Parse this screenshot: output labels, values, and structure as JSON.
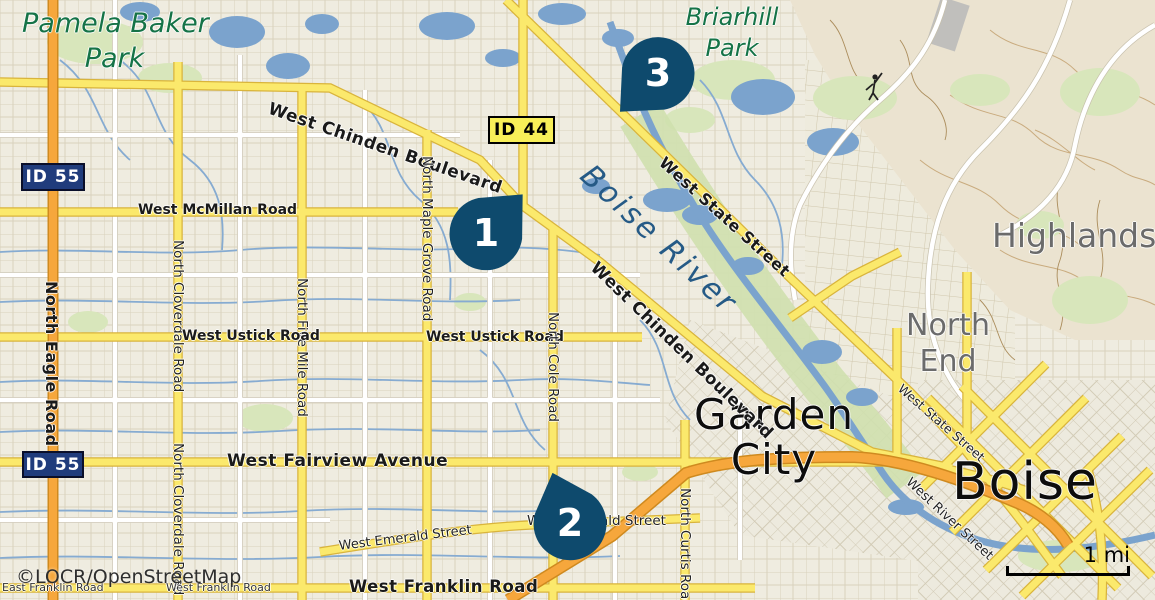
{
  "attribution": "©LOCR/OpenStreetMap",
  "scale_bar": {
    "label": "1 mi"
  },
  "markers": [
    {
      "number": "1"
    },
    {
      "number": "2"
    },
    {
      "number": "3"
    }
  ],
  "shields": {
    "id55_upper": "ID 55",
    "id55_lower": "ID 55",
    "id44": "ID 44"
  },
  "places": {
    "pamela_baker_park_line1": "Pamela Baker",
    "pamela_baker_park_line2": "Park",
    "briarhill_park_line1": "Briarhill",
    "briarhill_park_line2": "Park",
    "boise_river": "Boise River",
    "garden_city_line1": "Garden",
    "garden_city_line2": "City",
    "boise": "Boise",
    "highlands": "Highlands",
    "north_end_line1": "North",
    "north_end_line2": "End"
  },
  "roads": {
    "west_chinden_boulevard": "West Chinden Boulevard",
    "west_state_street": "West State Street",
    "north_eagle_road": "North Eagle Road",
    "west_mcmillan_road": "West McMillan Road",
    "north_cloverdale_road": "North Cloverdale Road",
    "north_five_mile_road": "North Five Mile Road",
    "north_maple_grove_road": "North Maple Grove Road",
    "west_ustick_road": "West Ustick Road",
    "north_cole_road": "North Cole Road",
    "west_fairview_avenue": "West Fairview Avenue",
    "west_emerald_street": "West Emerald Street",
    "north_curtis_road": "North Curtis Road",
    "west_franklin_road": "West Franklin Road",
    "east_franklin_road": "East Franklin Road",
    "west_river_street": "West River Street"
  },
  "colors": {
    "marker_fill": "#0e4a6d",
    "shield_blue": "#203c7c",
    "shield_yellow": "#f8ef58",
    "water": "#7ba3cd",
    "road_yellow": "#fbe96c",
    "road_orange": "#f6a73c",
    "park_green_text": "#157347",
    "river_label": "#255a86",
    "district_gray": "#6b6b6b"
  }
}
